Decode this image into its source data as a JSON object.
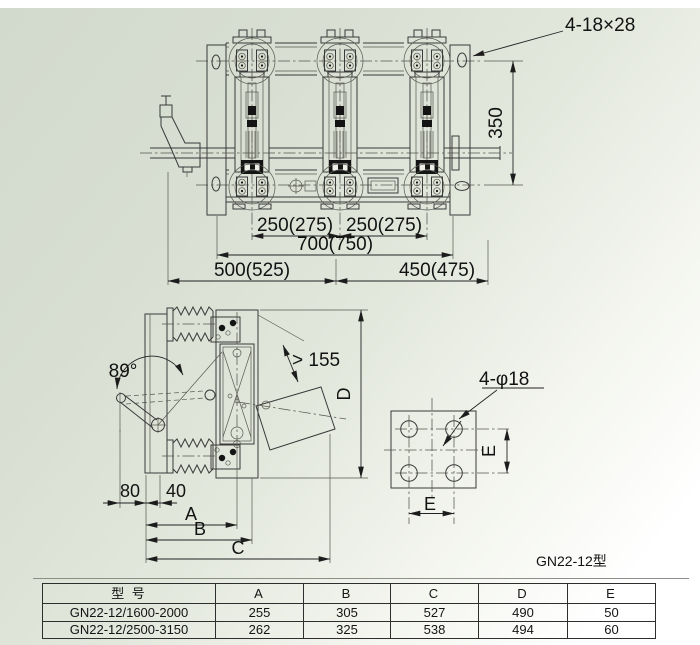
{
  "meta": {
    "caption": "GN22-12型",
    "style": {
      "background_tint": "#d5dcd0",
      "ink": "#2f2f2f"
    }
  },
  "top_view": {
    "slot_note": "4-18×28",
    "dim_height": "350",
    "dim_pitch_left": "250(275)",
    "dim_pitch_right": "250(275)",
    "dim_overall": "700(750)",
    "dim_left_span": "500(525)",
    "dim_right_span": "450(475)"
  },
  "side_view": {
    "angle": "89°",
    "clearance": "> 155",
    "dim_80": "80",
    "dim_40": "40",
    "dim_a": "A",
    "dim_b": "B",
    "dim_c": "C",
    "dim_d": "D"
  },
  "plate_view": {
    "holes_note": "4-φ18",
    "dim_e_right": "E",
    "dim_e_bottom": "E"
  },
  "table": {
    "headers": [
      "型 号",
      "A",
      "B",
      "C",
      "D",
      "E"
    ],
    "rows": [
      [
        "GN22-12/1600-2000",
        "255",
        "305",
        "527",
        "490",
        "50"
      ],
      [
        "GN22-12/2500-3150",
        "262",
        "325",
        "538",
        "494",
        "60"
      ]
    ]
  }
}
